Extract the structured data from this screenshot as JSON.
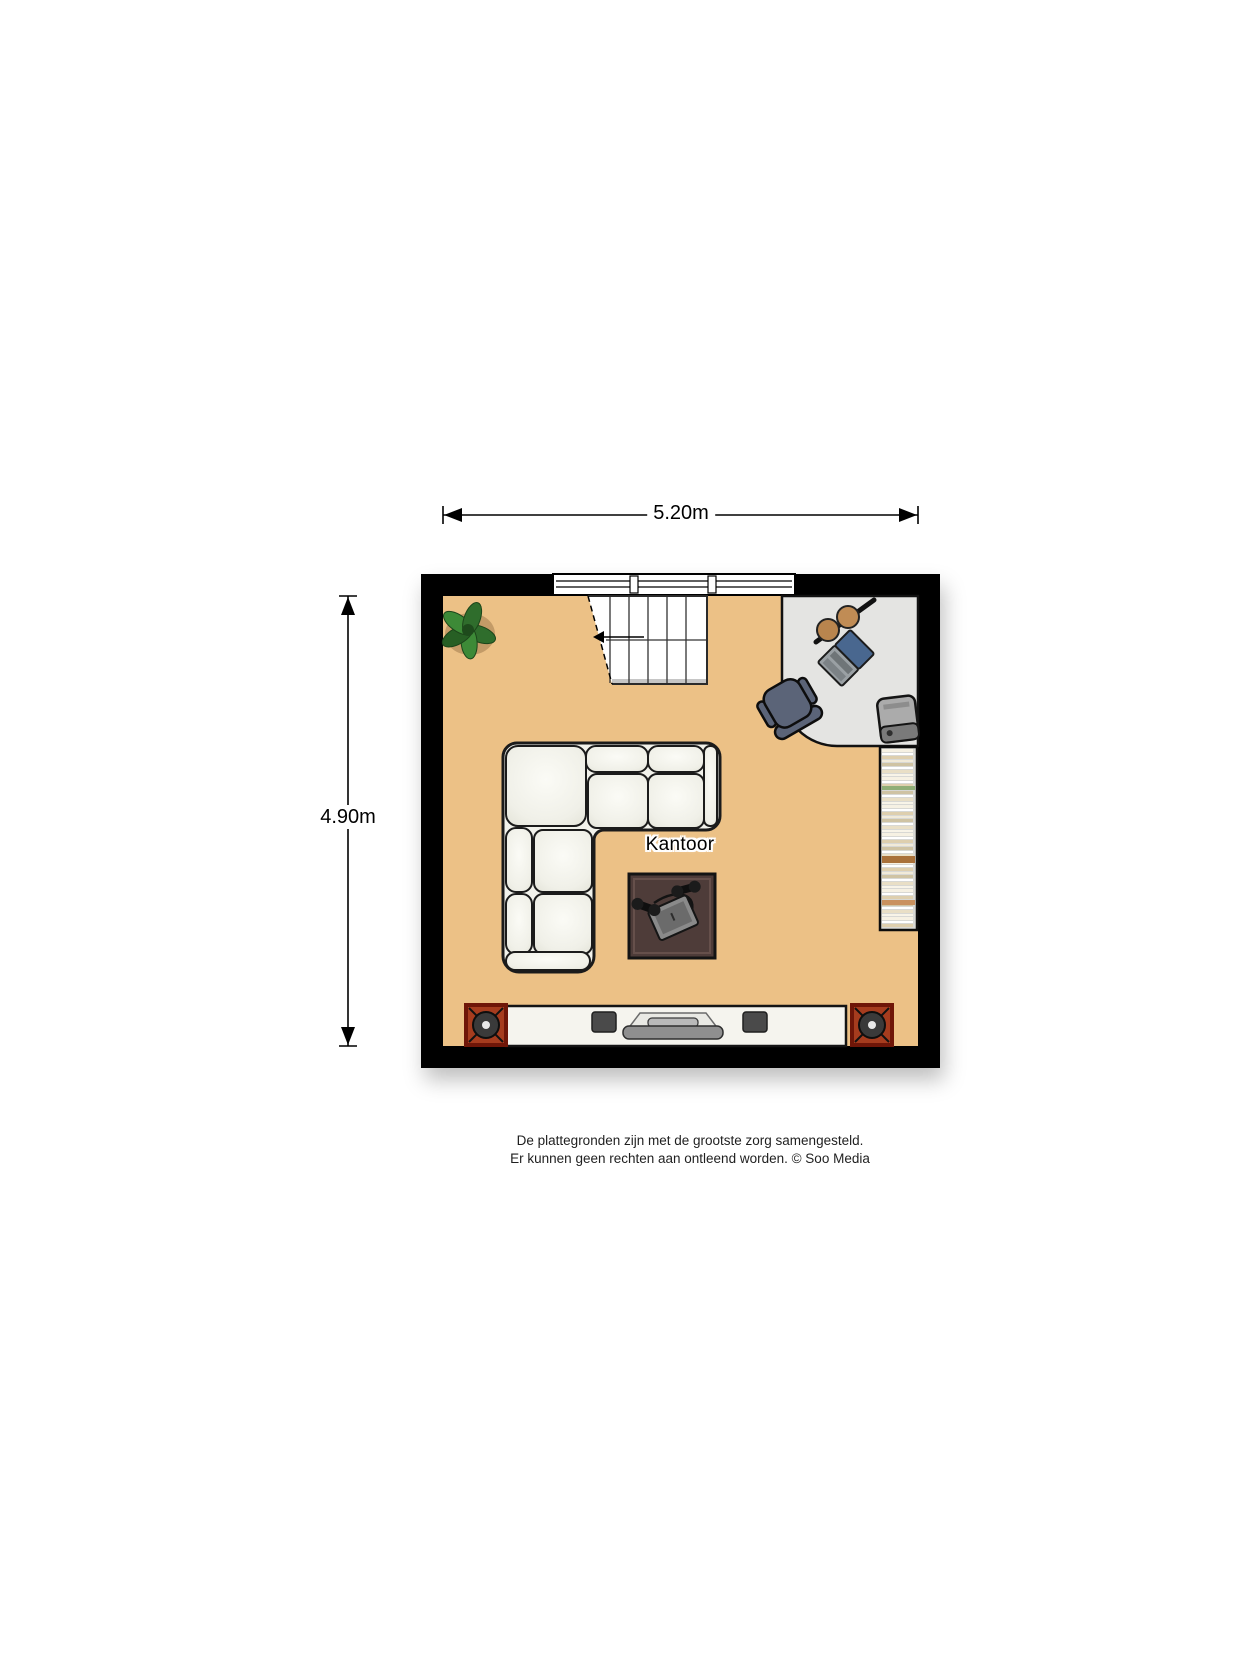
{
  "floorplan": {
    "room_label": "Kantoor",
    "dimension_width": "5.20m",
    "dimension_height": "4.90m",
    "colors": {
      "floor": "#ecc186",
      "wall": "#000000",
      "desk": "#e4e4e2",
      "chair": "#5b6478",
      "laptop_screen": "#49678f",
      "lamp_disc": "#b9854e",
      "sofa": "#f2f2eb",
      "coffee_table": "#4e3c39",
      "cabinet": "#f5f4ee",
      "speaker_box": "#a63c1e",
      "shelf": "#d8d8d4",
      "plant": "#2f6d2c"
    },
    "furniture": [
      "window",
      "staircase",
      "plant",
      "desk",
      "office-chair",
      "laptop",
      "desk-lamp",
      "printer",
      "bookshelf",
      "corner-sofa",
      "coffee-table",
      "tv-cabinet",
      "tv",
      "floor-speaker-left",
      "floor-speaker-right"
    ]
  },
  "footer": {
    "line1": "De plattegronden zijn met de grootste zorg samengesteld.",
    "line2": "Er kunnen geen rechten aan ontleend worden. © Soo Media"
  }
}
